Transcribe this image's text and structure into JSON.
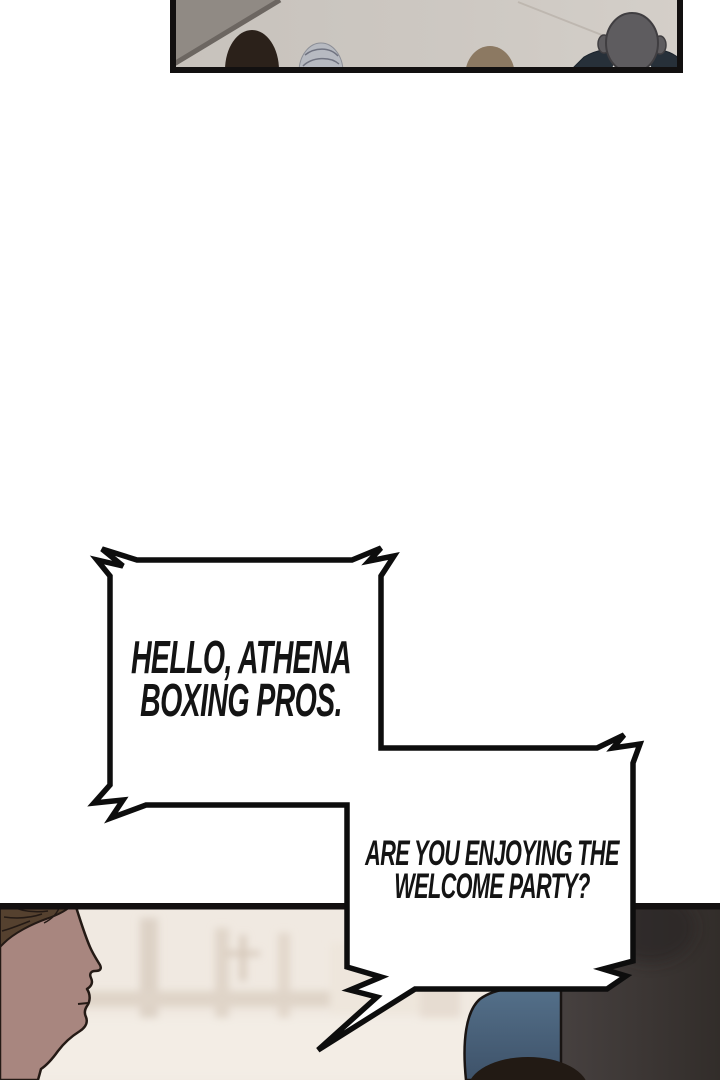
{
  "comic": {
    "speech_bubbles": [
      {
        "id": "bubble-1",
        "lines": [
          "HELLO, ATHENA",
          "BOXING PROS."
        ]
      },
      {
        "id": "bubble-2",
        "lines": [
          "ARE YOU ENJOYING THE",
          "WELCOME PARTY?"
        ]
      }
    ],
    "panels": [
      {
        "id": "panel-top",
        "art": "audience-heads-from-behind"
      },
      {
        "id": "panel-bottom",
        "art": "blond-man-profile-in-bright-hall"
      }
    ],
    "colors": {
      "page_bg": "#ffffff",
      "ink": "#0d0d0d",
      "bubble_fill": "#ffffff",
      "panel_top_bg": "#cbc5bf",
      "panel_bottom_bg": "#f0e9e1",
      "skin": "#a8867f",
      "suit_navy": "#273039",
      "shoulder_blue": "#4d6379",
      "silhouette_gray": "#3f3936",
      "silver_hair": "#b7bac1",
      "dark_hair": "#2b211a"
    }
  }
}
